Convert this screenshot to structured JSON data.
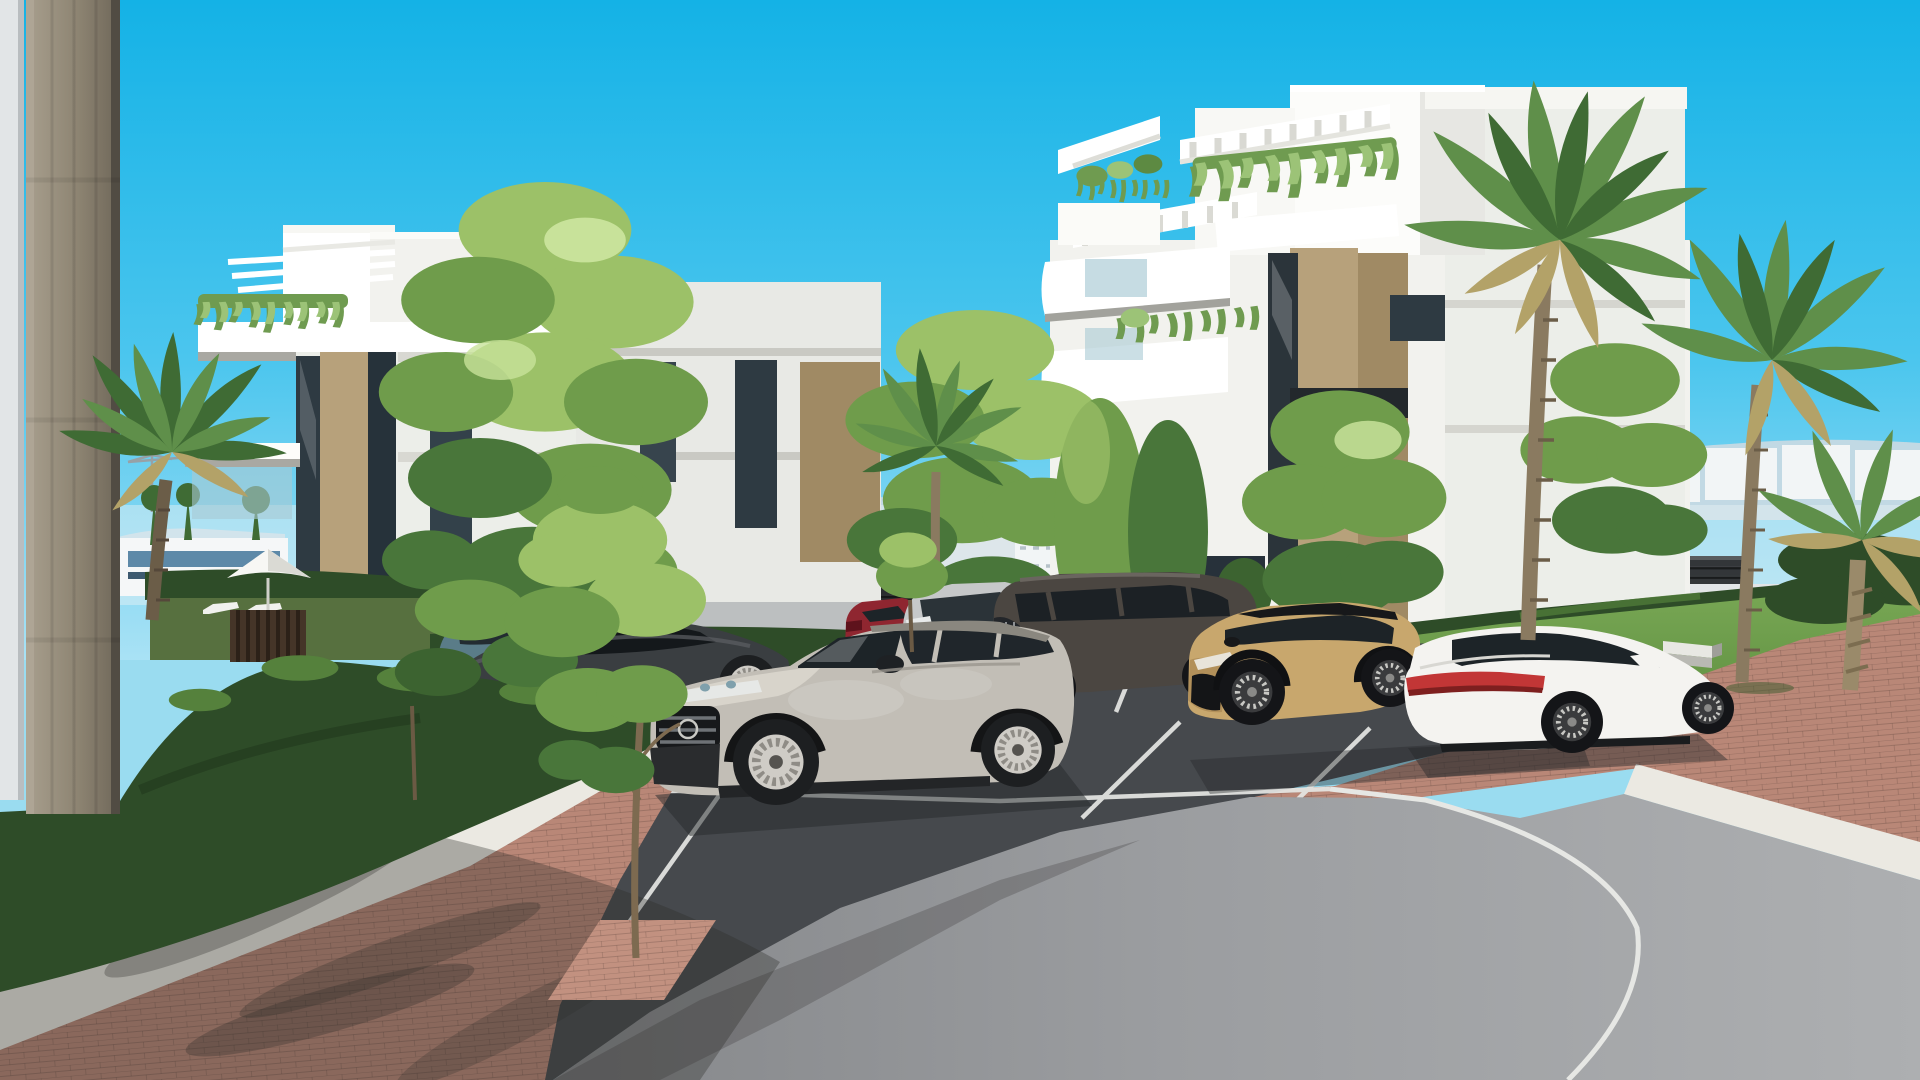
{
  "meta": {
    "title": "New-build residential complex — exterior 3D architectural visualization",
    "canvas": {
      "width": 1920,
      "height": 1080
    },
    "scene_objects": [
      {
        "id": "sky",
        "desc": "clear cyan gradient sky"
      },
      {
        "id": "distant-mountains",
        "desc": "pale blue mountain ridge on horizon"
      },
      {
        "id": "distant-city",
        "desc": "low white town buildings behind boundary fence"
      },
      {
        "id": "boundary-fence",
        "desc": "dark horizontal-slat perimeter fence"
      },
      {
        "id": "concrete-pillar",
        "desc": "foreground board-formed concrete pillar, left edge"
      },
      {
        "id": "building-left",
        "desc": "white 4-storey apartment block with roof pergola and hanging plants"
      },
      {
        "id": "building-right",
        "desc": "white 4-storey apartment block with pergolas, balconies and tan stone piers"
      },
      {
        "id": "pool-area",
        "desc": "white parasol, two sun loungers and dark slatted gate behind hedge"
      },
      {
        "id": "parking",
        "desc": "dark asphalt parking bays with white markings"
      },
      {
        "id": "road-curve",
        "desc": "curved grey access road with white lane line"
      },
      {
        "id": "brick-paving",
        "desc": "rose clay-brick walkways"
      },
      {
        "id": "gravel-strip",
        "desc": "white decorative gravel band"
      },
      {
        "id": "lawn",
        "desc": "sunlit green lawn with concrete benches and palms"
      },
      {
        "id": "car-grey-suv",
        "desc": "light grey electric SUV, foreground, front three-quarter"
      },
      {
        "id": "car-white-sedan",
        "desc": "white fastback sedan with red light bar, rear three-quarter"
      },
      {
        "id": "car-tan-crossover",
        "desc": "sand-tan compact crossover with black roof"
      },
      {
        "id": "car-dark-suv",
        "desc": "dark grey large SUV"
      },
      {
        "id": "car-silver-suv",
        "desc": "silver SUV with chrome grille"
      },
      {
        "id": "car-red-hatch",
        "desc": "dark red compact car"
      },
      {
        "id": "car-dark-sedan",
        "desc": "graphite fastback sedan"
      },
      {
        "id": "car-teal-hatch",
        "desc": "teal-grey hatchback behind tree"
      },
      {
        "id": "car-driving-sedan",
        "desc": "silver sedan driving on rear road"
      },
      {
        "id": "palms",
        "desc": "tall fan palms and young palm in planter"
      },
      {
        "id": "trees",
        "desc": "light green deciduous trees and columnar shrubs"
      },
      {
        "id": "hedges",
        "desc": "clipped dark green hedges"
      }
    ]
  },
  "palette": {
    "sky_top": "#14b2e6",
    "sky_mid": "#4cc6ee",
    "sky_horizon": "#a9e2f5",
    "mountain": "#c6d9e3",
    "haze": "#e8f1f5",
    "city_white": "#f2f5f6",
    "city_shade": "#dde6ea",
    "city_dark": "#6d6156",
    "city_glass": "#5d89a8",
    "fence": "#2a2c2e",
    "road_back": "#b5b8b9",
    "wall_white": "#e2e5e7",
    "pillar": "#94想8b79",
    "pillar_light": "#a89f8e",
    "pillar_dark": "#6f6759",
    "building_white": "#f2f2ee",
    "building_bright": "#ffffff",
    "building_shade": "#dededa",
    "stone_tan": "#b7a17b",
    "stone_tan_dark": "#a08a64",
    "window_dark": "#2e3a42",
    "window_glass": "#a8c9d4",
    "plant_green": "#6f9b50",
    "plant_light": "#9cc377",
    "palm_green": "#5f8f4a",
    "palm_dark": "#3f6b34",
    "palm_dry": "#b3a268",
    "trunk_brown": "#8a7a60",
    "tree_light": "#9cc168",
    "tree_mid": "#6f9c4b",
    "tree_dark": "#49763a",
    "hedge_dark": "#2e4c28",
    "hedge_light": "#55813c",
    "grass": "#5b8c3c",
    "grass_light": "#79a855",
    "asphalt": "#46494d",
    "road_light": "#a3a5a7",
    "brick": "#b98777",
    "brick_light": "#c29180",
    "gravel": "#ebe9e2",
    "line_white": "#e6e7e4",
    "bench_concrete": "#e8e8e3",
    "shadow": "#2c2a28",
    "car_teal": "#5a7c88",
    "car_dark_sedan": "#3a3e41",
    "car_silver": "#cdd0d1",
    "car_red": "#8f2630",
    "car_silver_suv": "#c6c8c9",
    "car_dark_suv": "#4b4641",
    "car_tan": "#c8a76d",
    "car_white": "#f4f3f0",
    "car_grey": "#c2beb6",
    "taillight_red": "#c23636",
    "glass_dark": "#1d2428"
  }
}
